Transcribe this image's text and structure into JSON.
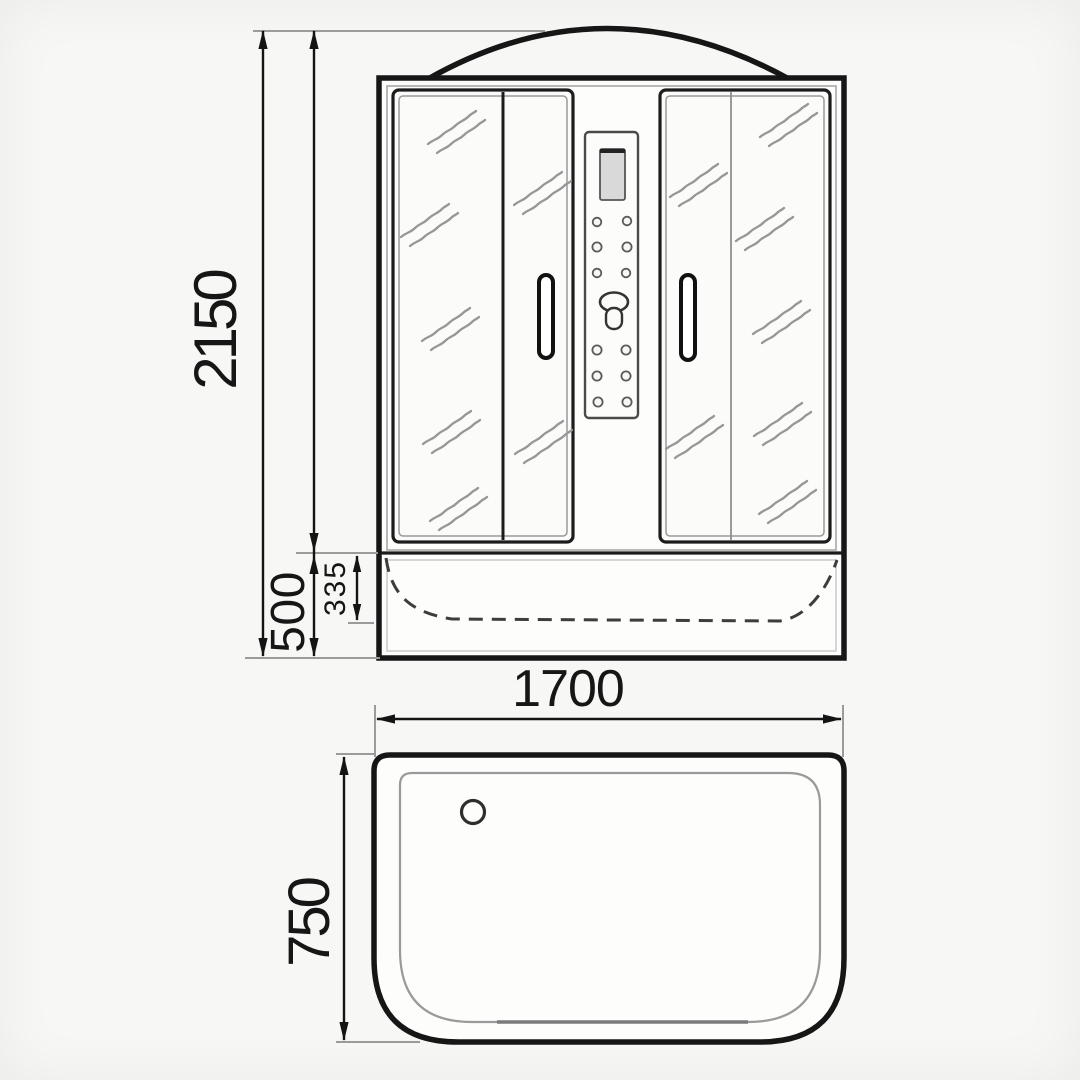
{
  "dimensions": {
    "overall_height": "2150",
    "tray_height": "500",
    "basin_inner_depth": "335",
    "overall_width": "1700",
    "overall_depth": "750"
  },
  "colors": {
    "background": "#f7f7f5",
    "outline": "#1a1a1a",
    "dimension_line": "#141414",
    "extension_line": "#9b9b9b",
    "glass_shine": "#979797",
    "dashed_basin": "#3d3d3d",
    "screen_fill": "#d9d9d9"
  },
  "icons": {
    "shower-knob-icon": "ellipse-with-droplet",
    "drain-icon": "small-circle",
    "glass-shine-icon": "double-diagonal-wavy-stroke",
    "door-handle-icon": "vertical-pill",
    "arrowhead-icon": "filled-triangle"
  }
}
